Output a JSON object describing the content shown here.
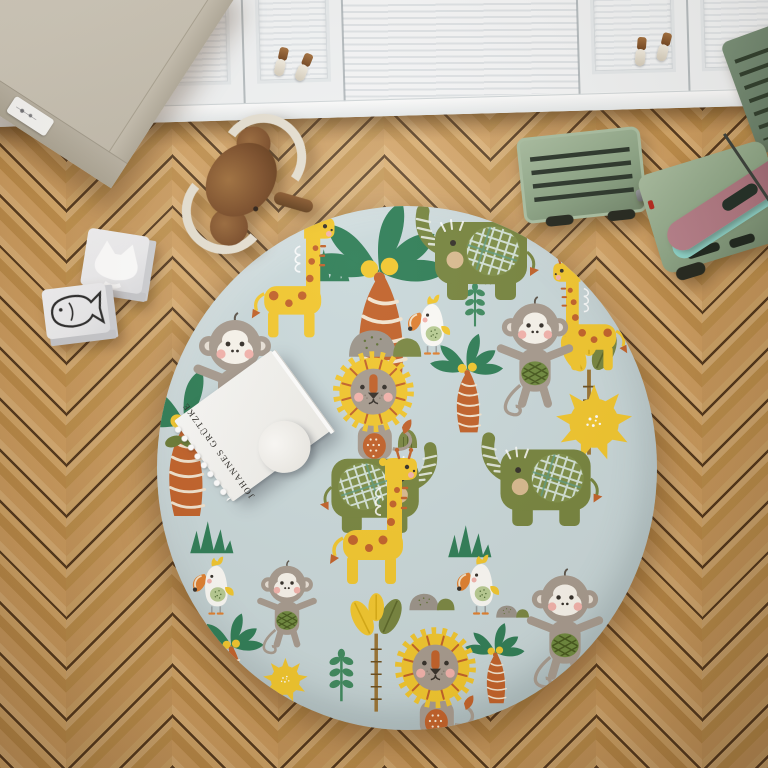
{
  "scene": {
    "description": "Top-down photo of a kids playroom: round safari-print rug on a herringbone wood floor, white closet doors along the top, beige cabinet in the corner, wooden toys scattered around",
    "view": "top-down"
  },
  "book": {
    "title": "JOHANNES GRÜTZKE",
    "type": "spiral-bound art book with classical painting cover and round white seal"
  },
  "rug": {
    "shape": "round",
    "theme": "jungle safari pattern",
    "animals": [
      "monkey",
      "lion",
      "elephant",
      "giraffe",
      "cockatoo",
      "toucan"
    ],
    "plants": [
      "palm tree",
      "paddle palm",
      "grass tuft",
      "leaf sprig",
      "striped bush"
    ],
    "extras": [
      "sun",
      "stones"
    ]
  },
  "toys": {
    "rocking_toy": "wooden rocking elephant",
    "blocks": [
      "fox picture block",
      "fish picture block"
    ],
    "truck": "green wooden toy truck with surfboards"
  },
  "furniture": {
    "closet": "white louvered closet doors with tassel handles",
    "cabinet": "beige corner cabinet with small label sticker"
  },
  "floor": {
    "pattern": "herringbone oak parquet"
  },
  "colors": {
    "wood-base": "#d2a162",
    "wood-light": "#ddb277",
    "wood-dark": "#c08f4b",
    "wood-gap": "#53381c",
    "cab-white": "#f1f3f4",
    "cab-line": "#d8dde0",
    "wr-top": "#cfc9bb",
    "wr-side": "#ada695",
    "rug-bg": "#c9d8da",
    "olive": "#77853f",
    "palm-green": "#2f7e57",
    "sprig-green": "#3f8a5f",
    "leaf-olive": "#6b7c36",
    "sun-yellow": "#f2c72e",
    "orange": "#c2622a",
    "fur-gray": "#a79b8f",
    "face-cream": "#f8f4ec",
    "cheek-pink": "#f3b3ac",
    "ink-dark": "#35302a",
    "truck-green": "#8ea687",
    "truck-dark": "#5e7560",
    "board-pink": "#ad7680",
    "board-teal": "#8fd7cd",
    "block-top": "#ececee",
    "block-side": "#cfd0d4",
    "toy-wood": "#7c4e2a",
    "rail-cream": "#e6e0d2"
  }
}
